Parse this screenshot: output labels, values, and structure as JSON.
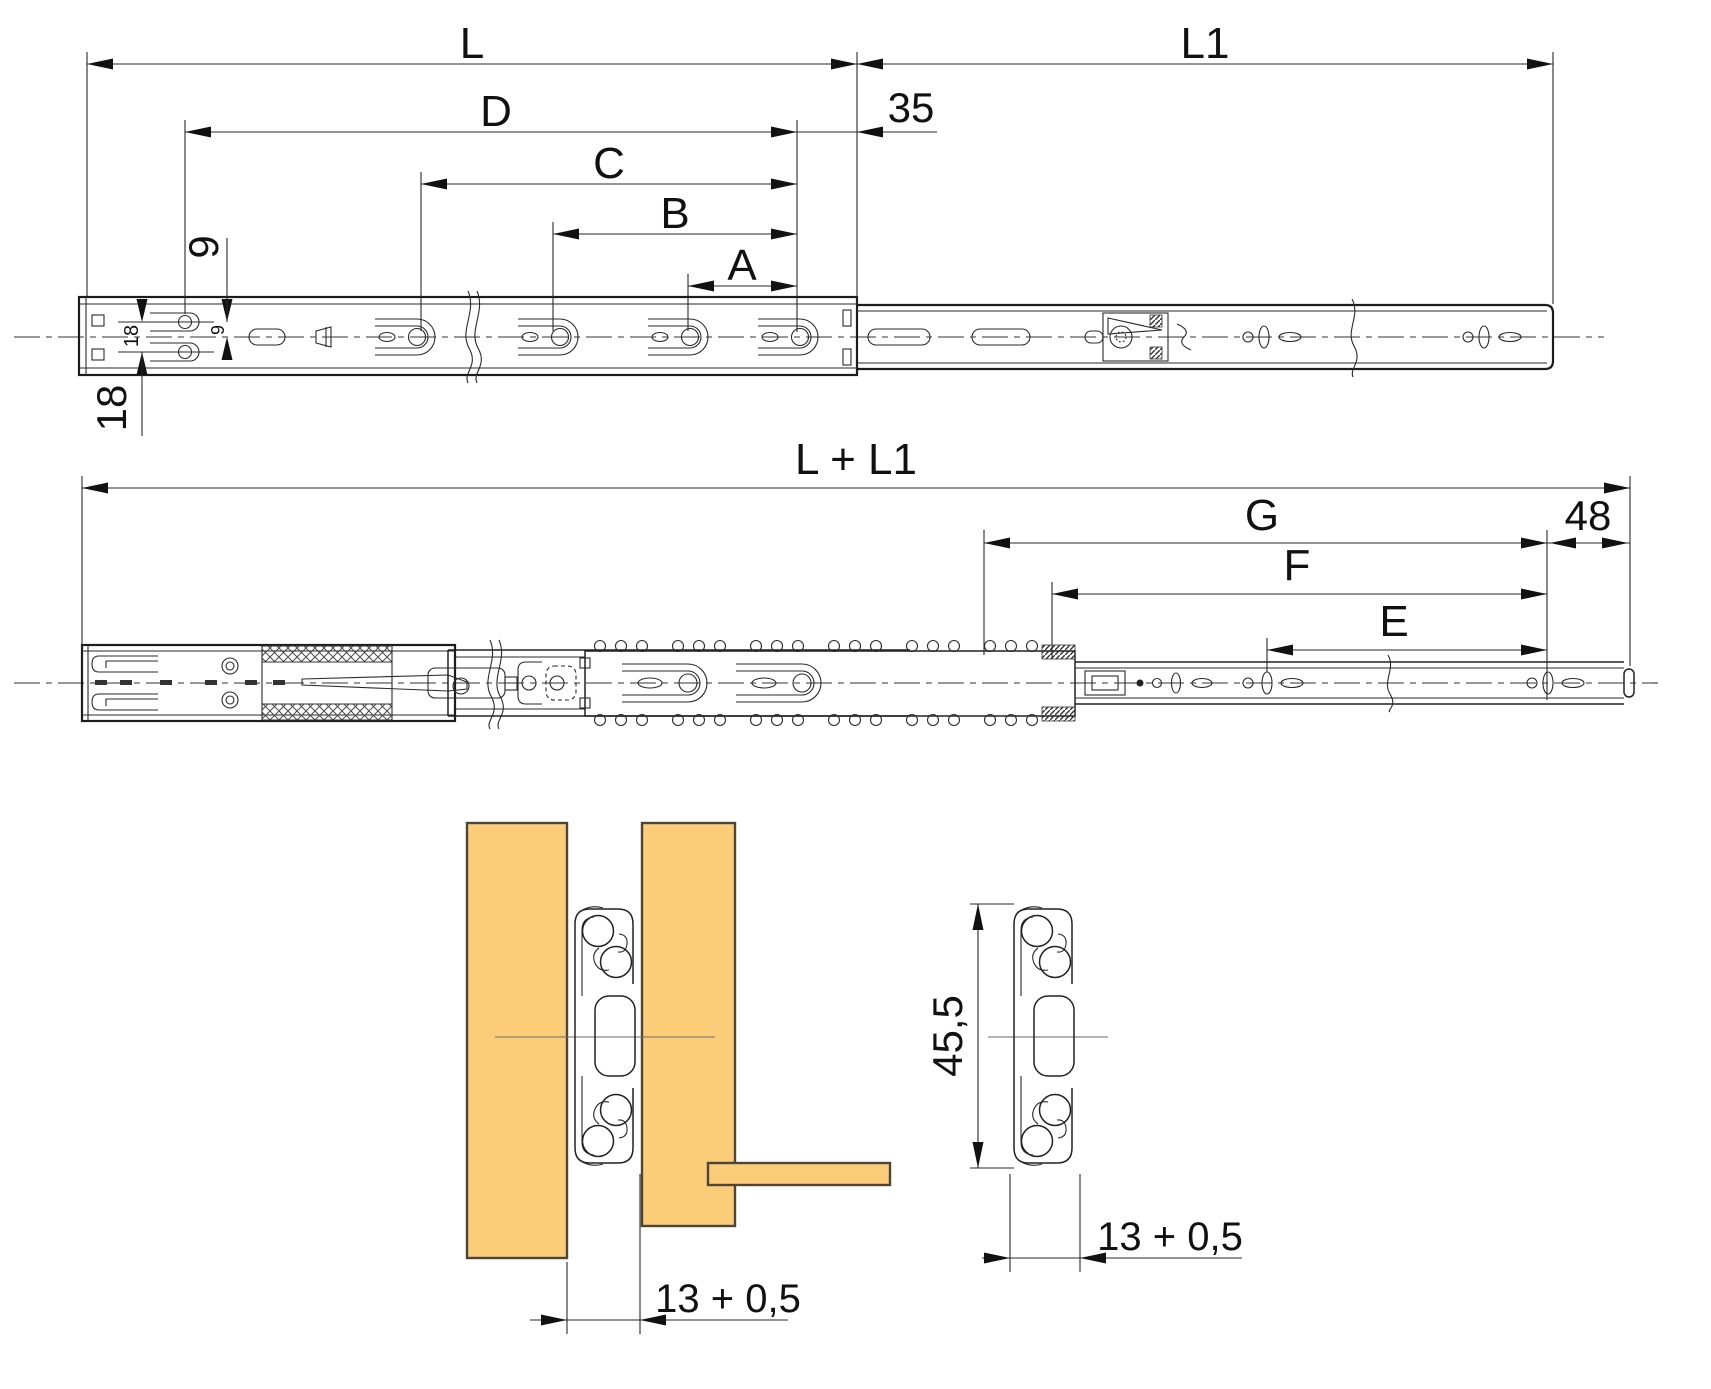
{
  "drawing": {
    "title": "drawer-slide-technical-drawing",
    "colors": {
      "line": "#1c1c1c",
      "wood_fill": "#FBCD79",
      "wood_stroke": "#4d4538"
    },
    "closed_view": {
      "length_label": "L",
      "extension_label": "L1",
      "dim_d": "D",
      "dim_c": "C",
      "dim_b": "B",
      "dim_a": "A",
      "rear_offset": "35",
      "hole_row_spacing": "18",
      "hole_row_spacing_small": "18",
      "row_to_center": "9",
      "row_to_center_small": "9"
    },
    "extended_view": {
      "total_length": "L + L1",
      "dim_g": "G",
      "dim_f": "F",
      "dim_e": "E",
      "front_offset": "48"
    },
    "cross_section": {
      "slide_height": "45,5",
      "clearance_left": "13 + 0,5",
      "clearance_right": "13 + 0,5"
    }
  }
}
